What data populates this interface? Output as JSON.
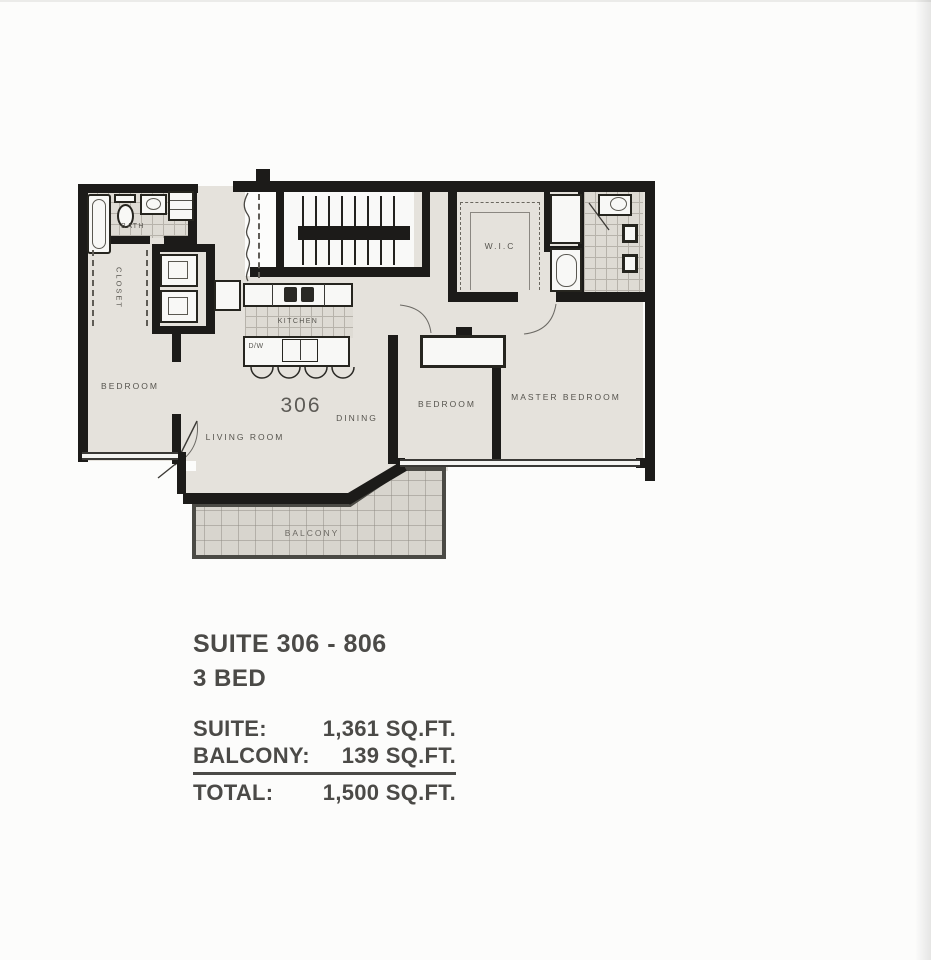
{
  "plan": {
    "labels": {
      "bath": "BATH",
      "closet": "CLOSET",
      "bedroom_left": "BEDROOM",
      "kitchen": "KITCHEN",
      "dw": "D/W",
      "living_room": "LIVING ROOM",
      "suite_number": "306",
      "dining": "DINING",
      "wic": "W.I.C",
      "bedroom_mid": "BEDROOM",
      "master_bedroom": "MASTER BEDROOM",
      "balcony": "BALCONY"
    },
    "colors": {
      "wall": "#1c1b19",
      "floor": "#e5e2dc",
      "tile": "#dedbd4",
      "label": "#56544e",
      "text": "#4b4a47"
    }
  },
  "summary": {
    "title": "SUITE 306 - 806",
    "subtitle": "3 BED",
    "rows": [
      {
        "label": "SUITE:",
        "value": "1,361 SQ.FT."
      },
      {
        "label": "BALCONY:",
        "value": "139 SQ.FT."
      },
      {
        "label": "TOTAL:",
        "value": "1,500 SQ.FT."
      }
    ]
  }
}
